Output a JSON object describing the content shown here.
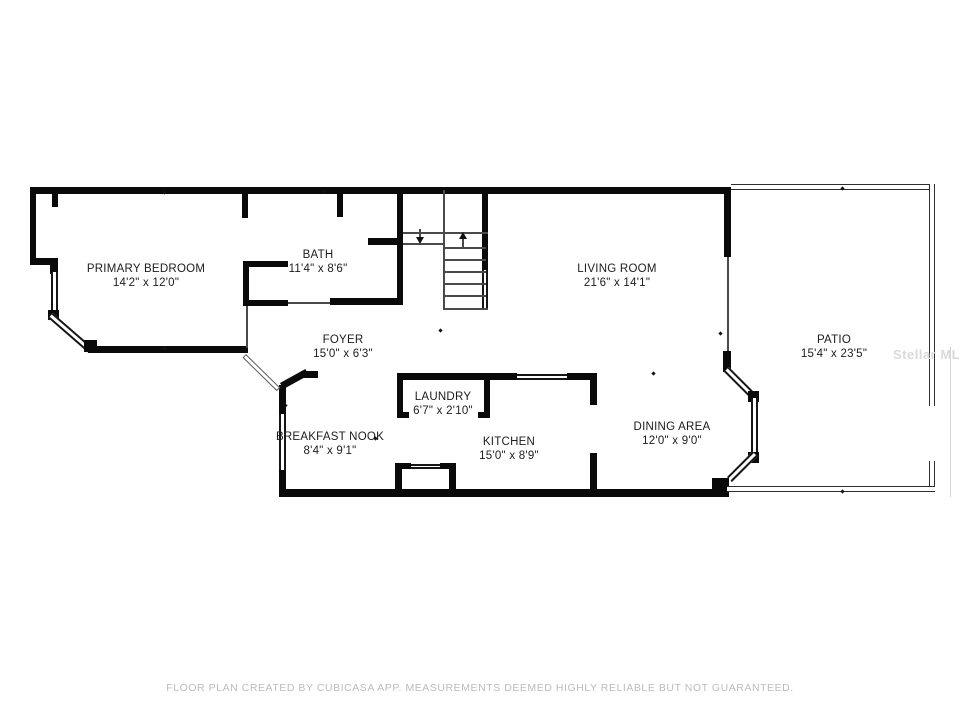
{
  "rooms": [
    {
      "name": "PRIMARY BEDROOM",
      "dims": "14'2\" x 12'0\""
    },
    {
      "name": "BATH",
      "dims": "11'4\" x 8'6\""
    },
    {
      "name": "FOYER",
      "dims": "15'0\" x 6'3\""
    },
    {
      "name": "LIVING ROOM",
      "dims": "21'6\" x 14'1\""
    },
    {
      "name": "LAUNDRY",
      "dims": "6'7\" x 2'10\""
    },
    {
      "name": "BREAKFAST NOOK",
      "dims": "8'4\" x 9'1\""
    },
    {
      "name": "KITCHEN",
      "dims": "15'0\" x 8'9\""
    },
    {
      "name": "DINING AREA",
      "dims": "12'0\" x 9'0\""
    },
    {
      "name": "PATIO",
      "dims": "15'4\" x 23'5\""
    }
  ],
  "footer": {
    "disclaimer": "FLOOR PLAN CREATED BY CUBICASA APP. MEASUREMENTS DEEMED HIGHLY RELIABLE BUT NOT GUARANTEED."
  },
  "watermark": {
    "text": "Stellar MLS"
  },
  "colors": {
    "wall": "#0a0a0a",
    "label_text": "#1c1c1c",
    "disclaimer_text": "#bcbcbc",
    "watermark_text": "#dadada"
  }
}
